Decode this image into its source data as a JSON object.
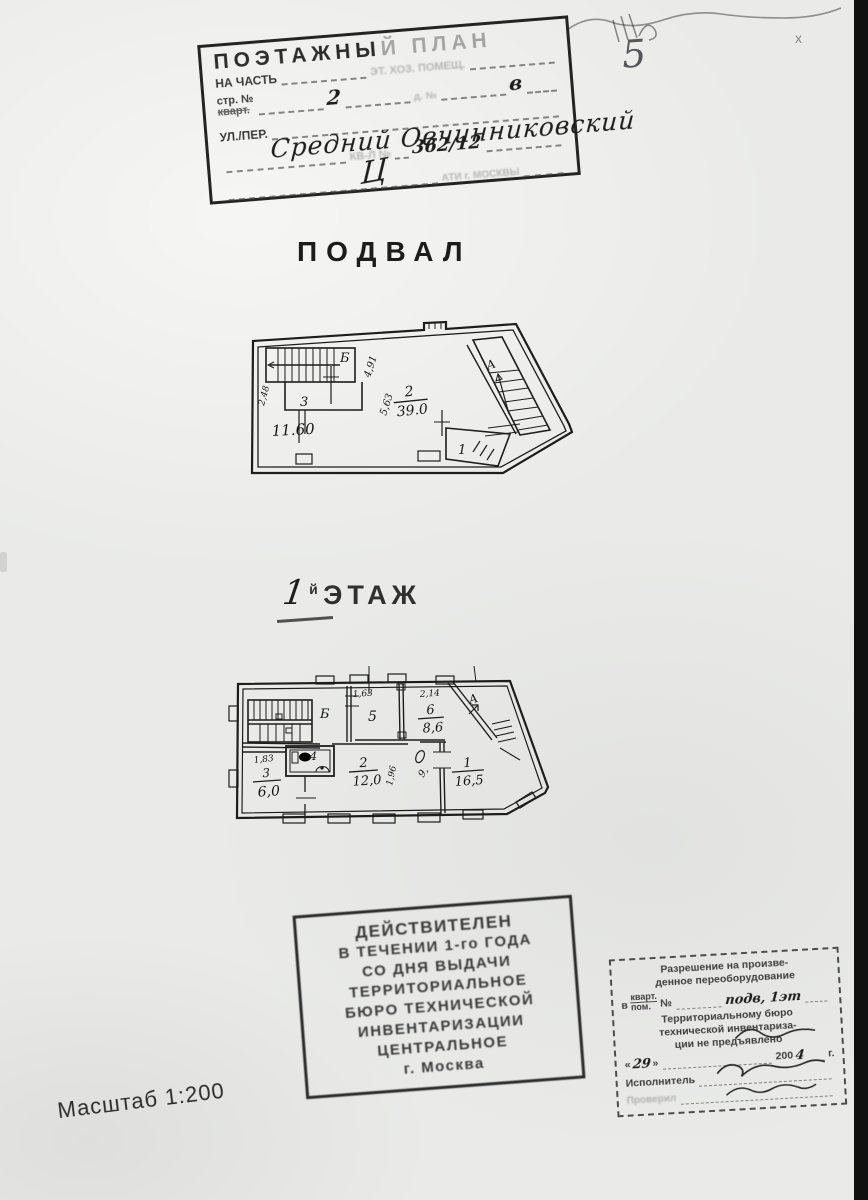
{
  "page": {
    "number": "5",
    "scale": "Масштаб 1:200",
    "cross_mark": "x"
  },
  "top_stamp": {
    "title_a": "ПОЭТАЖНЫ",
    "title_b": "Й ПЛАН",
    "faded_line": "ЭТ. ХОЗ. ПОМЕЩ.",
    "part_label": "НА ЧАСТЬ",
    "str_label": "стр. №",
    "str_struck": "кварт.",
    "str_value": "2",
    "house_faint": "д. №",
    "house_value": "в",
    "street_label": "УЛ./ПЕР.",
    "street_value": "Средний Овчинниковский",
    "kvartal_faint": "КВ-Л  №",
    "kvartal_value": "362/12",
    "signature": "Ц",
    "footer_faint": "АТИ г. МОСКВЫ"
  },
  "basement": {
    "heading": "ПОДВАЛ",
    "stair_b": "Б",
    "stair_a": "А",
    "room3": "3",
    "dim_248": "2,48",
    "dim_1160": "11.60",
    "room2_num": "2",
    "room2_area": "39.0",
    "dim_563": "5,63",
    "dim_491": "4,91",
    "room1": "1"
  },
  "floor1": {
    "heading_num": "1",
    "heading_suffix_small": "й",
    "heading_word": "ЭТАЖ",
    "stair_b": "Б",
    "stair_a": "А",
    "dim_163": "1,63",
    "room5": "5",
    "dim_214": "2,14",
    "room6_num": "6",
    "room6_area": "8,6",
    "dim_183": "1,83",
    "room3_num": "3",
    "room3_area": "6,0",
    "room4": "4",
    "room2_num": "2",
    "room2_area": "12,0",
    "dim_196": "1,96",
    "door_note": "9,",
    "room1_num": "1",
    "room1_area": "16,5"
  },
  "validity_stamp": {
    "lines": [
      "ДЕЙСТВИТЕЛЕН",
      "В ТЕЧЕНИИ 1-го ГОДА",
      "СО ДНЯ ВЫДАЧИ",
      "ТЕРРИТОРИАЛЬНОЕ",
      "БЮРО ТЕХНИЧЕСКОЙ",
      "ИНВЕНТАРИЗАЦИИ",
      "ЦЕНТРАЛЬНОЕ",
      "г. Москва"
    ]
  },
  "permission_stamp": {
    "line1": "Разрешение на произве-",
    "line2": "денное переоборудование",
    "prefix": "в",
    "kvart": "кварт.",
    "pom": "пом.",
    "no": "№",
    "hand_value": "подв, 1эт",
    "line4": "Территориальному бюро",
    "line5": "технической инвентариза-",
    "line6": "ции не предъявлено",
    "quote_open": "«",
    "date_day": "29",
    "quote_close": "»",
    "year_prefix": "200",
    "year_digit": "4",
    "year_suffix": "г.",
    "executor_label": "Исполнитель",
    "checked_label": "Проверил"
  }
}
